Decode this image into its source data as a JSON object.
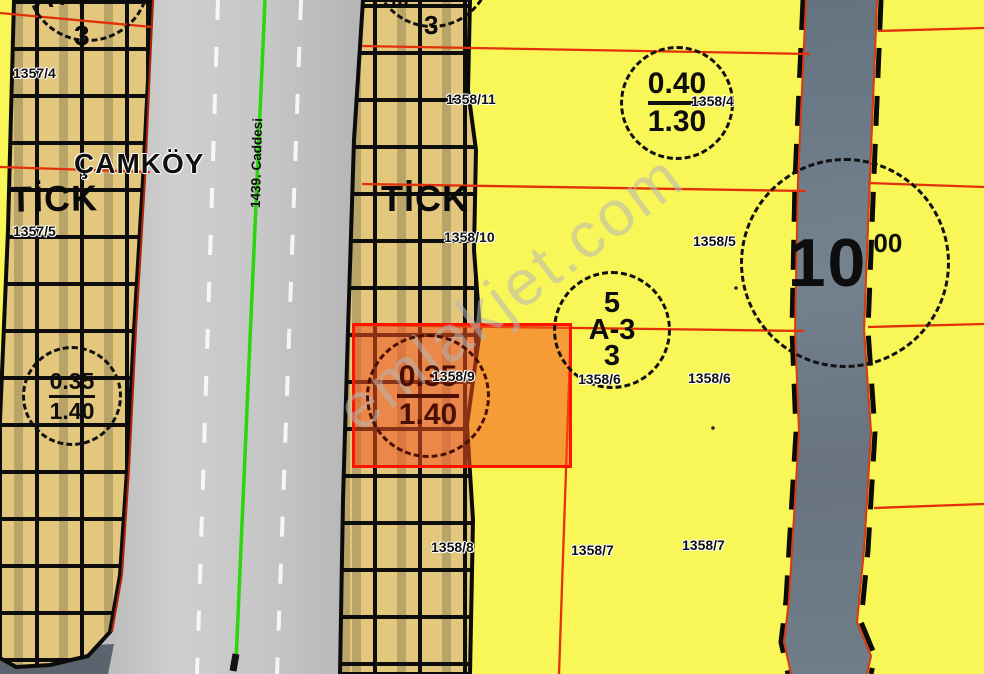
{
  "watermark": {
    "text": "emlakjet.com"
  },
  "street": {
    "name": "1439. Caddesi"
  },
  "district": {
    "name": "ÇAMKÖY"
  },
  "zones": {
    "left": "TİCK",
    "middle": "TİCK"
  },
  "parcels": {
    "p1357_4": "1357/4",
    "p1357_5": "1357/5",
    "p1358_11": "1358/11",
    "p1358_10": "1358/10",
    "p1358_9": "1358/9",
    "p1358_8": "1358/8",
    "p1358_4": "1358/4",
    "p1358_5": "1358/5",
    "p1358_6a": "1358/6",
    "p1358_6b": "1358/6",
    "p1358_7a": "1358/7",
    "p1358_7b": "1358/7"
  },
  "annotations": {
    "ratio_right": {
      "top": "0.40",
      "bottom": "1.30"
    },
    "ratio_left": {
      "top": "0.35",
      "bottom": "1.40"
    },
    "ratio_highlight": {
      "top": "0.35",
      "bottom": "1.40"
    },
    "block": {
      "line1": "5",
      "line2": "A-3",
      "line3": "3"
    },
    "road_width": {
      "value": "10",
      "sup": "00"
    },
    "partial_left": {
      "fragment": "A+4",
      "digit": "3"
    },
    "partial_mid": {
      "fragment": "m",
      "digit": "3"
    }
  },
  "colors": {
    "parcel_yellow": "#F9F657",
    "building_tan": "#E3C77D",
    "road_light": "#C9C9C9",
    "road_dark": "#6F7D8C",
    "boundary_red": "#E33109",
    "highlight_border": "#FF1400",
    "highlight_fill": "rgba(242,82,30,0.55)",
    "green_line": "#2BD60B"
  }
}
